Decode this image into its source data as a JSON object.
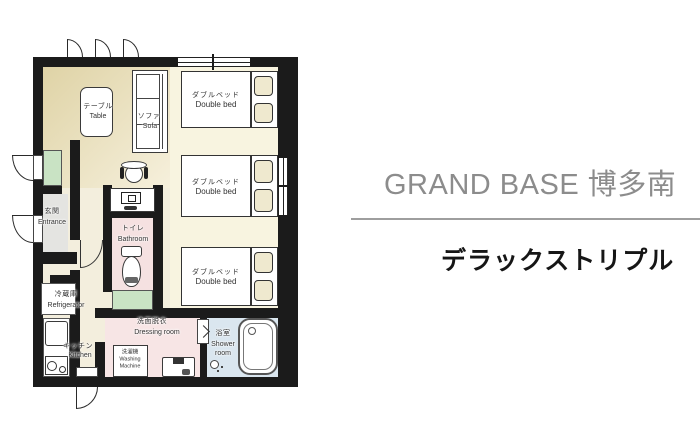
{
  "header": {
    "brand": "GRAND BASE 博多南",
    "room_type": "デラックストリプル"
  },
  "floorplan": {
    "colors": {
      "wall": "#1b1b1b",
      "living_start": "#dfd3a6",
      "living_end": "#f6f0dc",
      "bedroom": "#f8f4e0",
      "corridor": "#f3eedd",
      "entrance": "#e4e4e1",
      "toilet": "#f5e1e1",
      "dressing": "#f7e5e5",
      "shower": "#dae6ef",
      "green": "#c9e3c4",
      "brand_text": "#8c8c8c",
      "divider": "#9e9e9e",
      "room_type_text": "#161616"
    },
    "labels": {
      "table": {
        "jp": "テーブル",
        "en": "Table"
      },
      "sofa": {
        "jp": "ソファ",
        "en": "Sofa"
      },
      "entrance": {
        "jp": "玄関",
        "en": "Entrance"
      },
      "toilet": {
        "jp": "トイレ",
        "en": "Bathroom"
      },
      "refrigerator": {
        "jp": "冷蔵庫",
        "en": "Refrigerator"
      },
      "kitchen": {
        "jp": "キッチン",
        "en": "Kitchen"
      },
      "dressing": {
        "jp": "洗面脱衣",
        "en": "Dressing room"
      },
      "washing_machine": {
        "jp": "洗濯機",
        "en_line1": "Washing",
        "en_line2": "Machine"
      },
      "shower": {
        "jp": "浴室",
        "en_line1": "Shower",
        "en_line2": "room"
      },
      "beds": [
        {
          "jp": "ダブルベッド",
          "en": "Double bed"
        },
        {
          "jp": "ダブルベッド",
          "en": "Double bed"
        },
        {
          "jp": "ダブルベッド",
          "en": "Double bed"
        }
      ]
    }
  }
}
